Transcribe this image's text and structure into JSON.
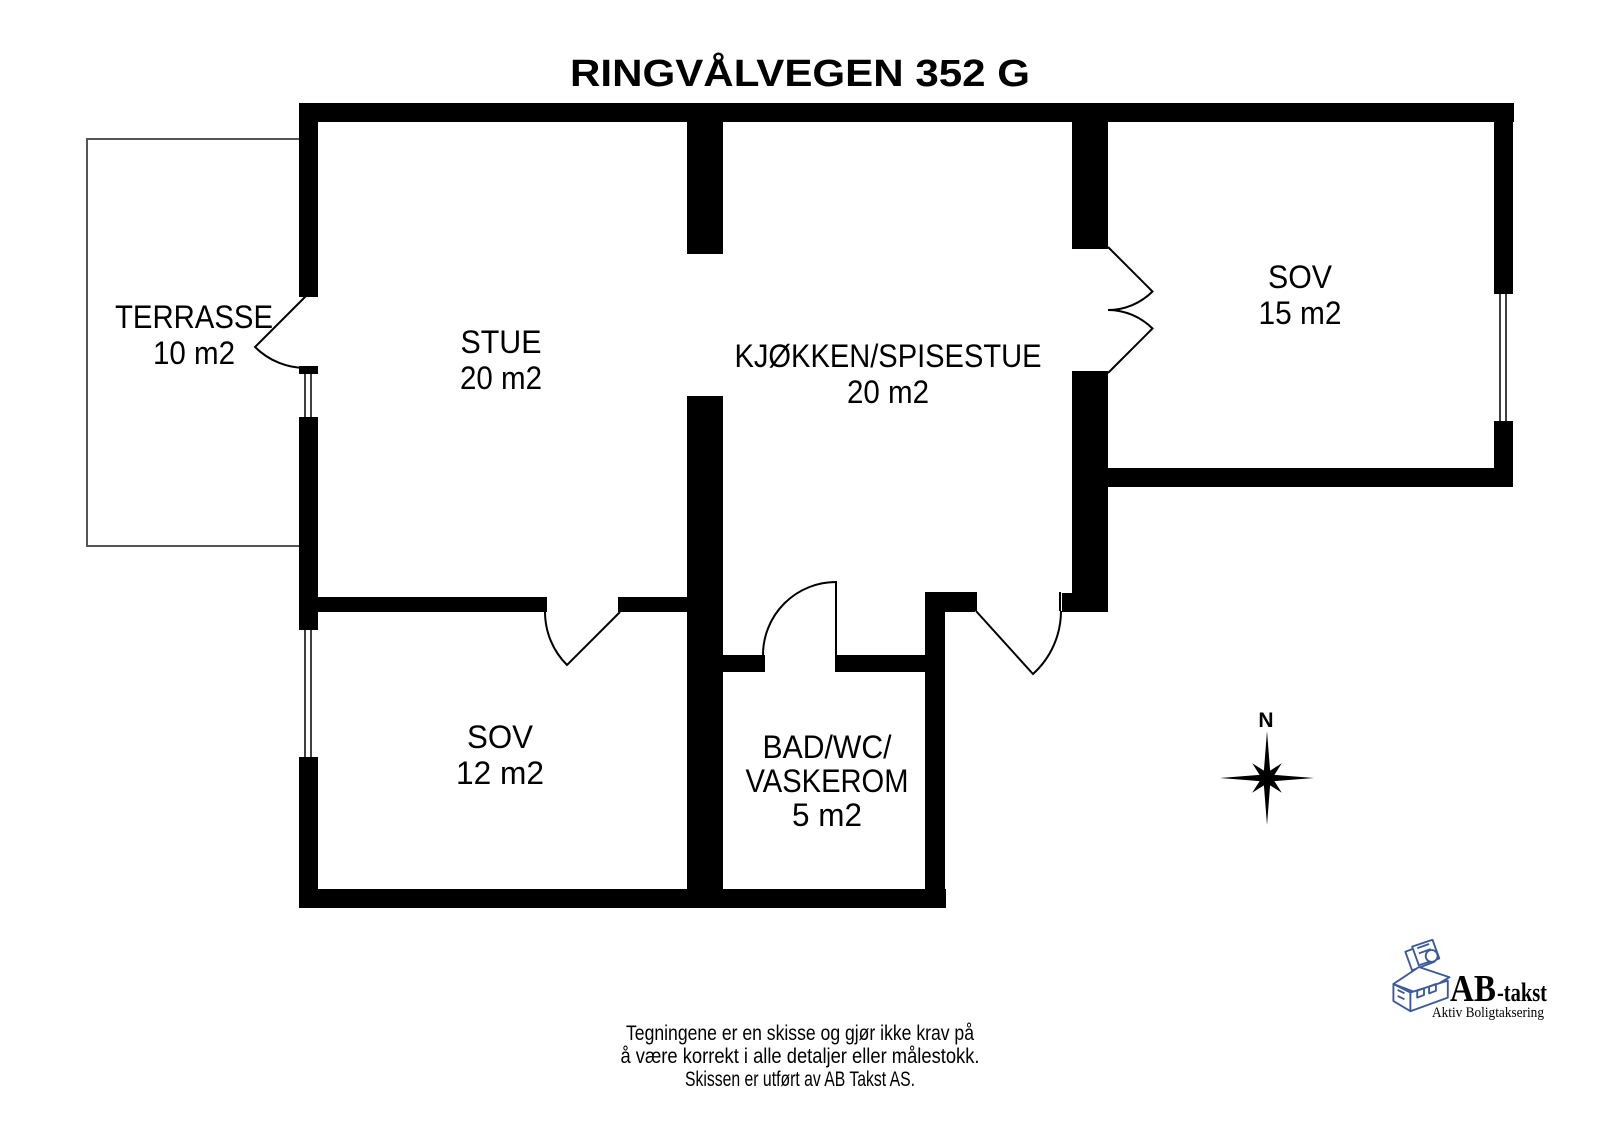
{
  "title": "RINGVÅLVEGEN 352 G",
  "rooms": {
    "terrasse": {
      "name": "TERRASSE",
      "area": "10 m2"
    },
    "stue": {
      "name": "STUE",
      "area": "20 m2"
    },
    "kjokken_spisestue": {
      "name": "KJØKKEN/SPISESTUE",
      "area": "20 m2"
    },
    "sov_15": {
      "name": "SOV",
      "area": "15 m2"
    },
    "sov_12": {
      "name": "SOV",
      "area": "12 m2"
    },
    "bad_wc_vaskerom": {
      "name_line1": "BAD/WC/",
      "name_line2": "VASKEROM",
      "area": "5 m2"
    }
  },
  "compass": {
    "north_label": "N"
  },
  "disclaimer": {
    "line1": "Tegningene er en skisse og gjør ikke krav på",
    "line2": "å være korrekt i alle detaljer eller målestokk.",
    "line3": "Skissen er utført av AB Takst AS."
  },
  "logo": {
    "brand": "AB",
    "brand_suffix": "-takst",
    "tagline": "Aktiv Boligtaksering"
  },
  "colors": {
    "walls": "#000000",
    "background": "#ffffff",
    "logo_red": "#b92427",
    "logo_blue": "#2e4470",
    "logo_house_blue": "#3b5a9b"
  }
}
